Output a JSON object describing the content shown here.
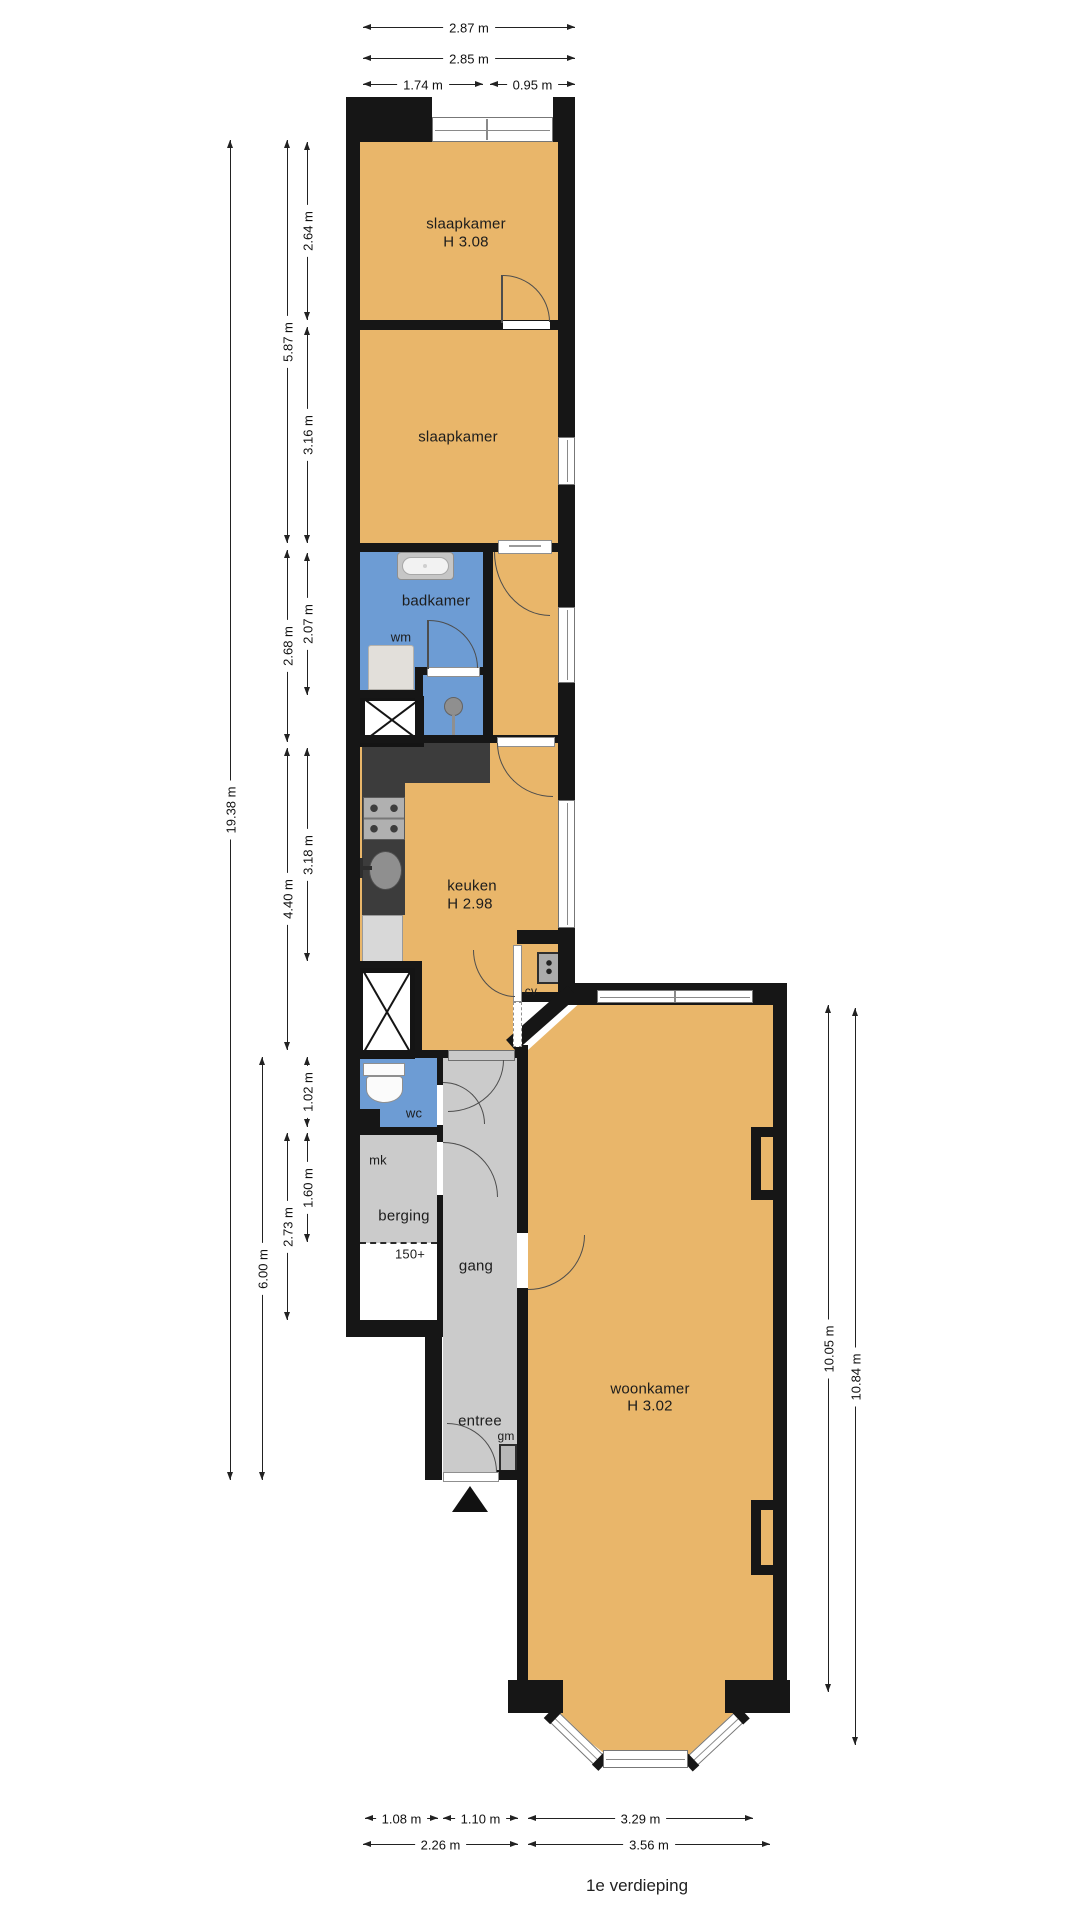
{
  "floor_title": "1e verdieping",
  "rooms": {
    "bedroom1": {
      "name": "slaapkamer",
      "height": "H 3.08"
    },
    "bedroom2": {
      "name": "slaapkamer"
    },
    "bathroom": {
      "name": "badkamer"
    },
    "kitchen": {
      "name": "keuken",
      "height": "H 2.98"
    },
    "living_room": {
      "name": "woonkamer",
      "height": "H 3.02"
    },
    "toilet": {
      "name": "wc"
    },
    "meter_closet": {
      "name": "mk"
    },
    "storage": {
      "name": "berging",
      "ceiling_marker": "150+"
    },
    "hallway": {
      "name": "gang"
    },
    "entry": {
      "name": "entree"
    }
  },
  "appliances": {
    "washing_machine": "wm",
    "central_heating": "cv",
    "gas_meter": "gm"
  },
  "dimensions": {
    "top": [
      "2.87 m",
      "2.85 m",
      "1.74 m",
      "0.95 m"
    ],
    "bottom": [
      "1.08 m",
      "1.10 m",
      "3.29 m",
      "2.26 m",
      "3.56 m"
    ],
    "left": [
      "19.38 m",
      "6.00 m",
      "5.87 m",
      "2.68 m",
      "4.40 m",
      "2.73 m",
      "2.64 m",
      "3.16 m",
      "2.07 m",
      "3.18 m",
      "1.02 m",
      "1.60 m"
    ],
    "right": [
      "10.05 m",
      "10.84 m"
    ]
  },
  "colors": {
    "floor": "#e9b66a",
    "wet_room": "#6d9cd4",
    "corridor": "#cbcbcb",
    "wall": "#161616",
    "counter_dark": "#3c3c3c"
  }
}
